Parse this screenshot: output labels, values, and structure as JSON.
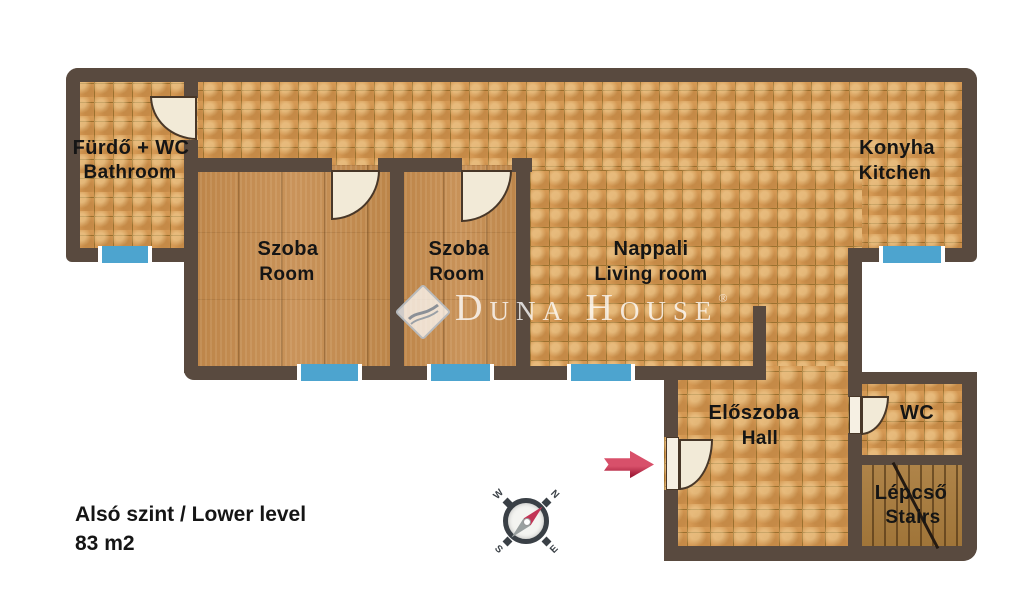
{
  "plan": {
    "level_title": "Alsó szint / Lower level",
    "area": "83 m2",
    "watermark": {
      "brand": "Duna House",
      "registered": "®"
    },
    "compass": {
      "n": "N",
      "e": "E",
      "s": "S",
      "w": "W"
    },
    "rooms": [
      {
        "id": "bathroom",
        "name_hu": "Fürdő + WC",
        "name_en": "Bathroom"
      },
      {
        "id": "room1",
        "name_hu": "Szoba",
        "name_en": "Room"
      },
      {
        "id": "room2",
        "name_hu": "Szoba",
        "name_en": "Room"
      },
      {
        "id": "living",
        "name_hu": "Nappali",
        "name_en": "Living room"
      },
      {
        "id": "kitchen",
        "name_hu": "Konyha",
        "name_en": "Kitchen"
      },
      {
        "id": "hall",
        "name_hu": "Előszoba",
        "name_en": "Hall"
      },
      {
        "id": "wc",
        "name_hu": "WC",
        "name_en": ""
      },
      {
        "id": "stairs",
        "name_hu": "Lépcső",
        "name_en": "Stairs"
      }
    ],
    "colors": {
      "wall": "#594a3f",
      "tile": "#d49853",
      "tileline": "#9b712f",
      "wood": "#c28b51",
      "stairswood": "#a87c41",
      "window": "#4da4cf",
      "door": "#f2ead7",
      "arrow": "#c52e4d",
      "text": "#151515"
    }
  }
}
